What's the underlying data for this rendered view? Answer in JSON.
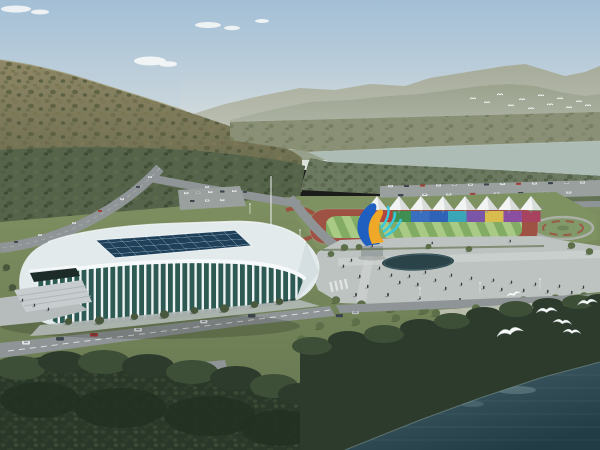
{
  "meta": {
    "type": "architectural-aerial-rendering",
    "description": "Aerial rendering of a riverside sports complex: white lattice-ribbed arena with gridded glass skylight, outdoor running track with rainbow banner wall and white canopy tents, colorful flame sculpture, pedestrian plaza with pond, tree-lined roads, wooded shoreline, dark river with white gulls and a mountain backdrop.",
    "width_px": 600,
    "height_px": 450
  },
  "palette": {
    "sky_top": "#a3bfd6",
    "sky_mid": "#c6d4dc",
    "sky_horizon": "#dee2dd",
    "cloud_white": "#f5f7f7",
    "ridge_far": "#a8ad9c",
    "ridge_near": "#949c86",
    "hill_light": "#8e8765",
    "hill_dark": "#5f6448",
    "valley_trees": "#55644a",
    "farmland": "#899075",
    "river_water": "#adbdb6",
    "river_bank": "#6d7a62",
    "grass_light": "#7e8f60",
    "grass_dark": "#647550",
    "lawn_green": "#7d9161",
    "flower_red": "#a04b3e",
    "road_asphalt": "#8f9596",
    "road_marking": "#eceff0",
    "parking_lot": "#9aa09e",
    "stadium_roof": "#e3eaec",
    "stadium_fascia": "#f5f9f9",
    "stadium_skylight": "#20405a",
    "skylight_grid": "#9cc0cd",
    "stadium_glass": "#2e5a54",
    "stadium_rib": "#edf3f3",
    "track_red": "#9e5244",
    "field_green_light": "#a9ca85",
    "field_green_dark": "#82ab63",
    "tent_white": "#f2f4f3",
    "plaza_grey": "#bdc3c1",
    "plaza_path": "#d0d5d3",
    "pond_dark": "#2a4349",
    "tree_olive": "#5c6f48",
    "tree_dark_olive": "#47583c",
    "forest_dark": "#2c3b2c",
    "forest_mid": "#3d4f37",
    "water_top": "#46626b",
    "water_bottom": "#223c46",
    "water_sparkle": "#7b969c",
    "bird_white": "#f8fafa",
    "sculpture_blue": "#1f5fc0",
    "sculpture_yellow": "#f0a828",
    "sculpture_cyan": "#38c8de",
    "car_white": "#e6e9e9",
    "car_red": "#b03a30",
    "car_dark": "#39424a",
    "car_silver": "#b9bec2",
    "pedestrian": "#373c41"
  },
  "banner_colors": [
    "#b5443c",
    "#3f8f55",
    "#3a6fc0",
    "#2f63b8",
    "#3aa7b8",
    "#7b55a8",
    "#d8bc4e",
    "#8a4fa0",
    "#a8435f"
  ],
  "counts": {
    "canopy_tents": 8,
    "banner_panels": 9,
    "foreground_gulls": 6,
    "distant_flock_birds": 12,
    "cloud_clusters": 3
  }
}
